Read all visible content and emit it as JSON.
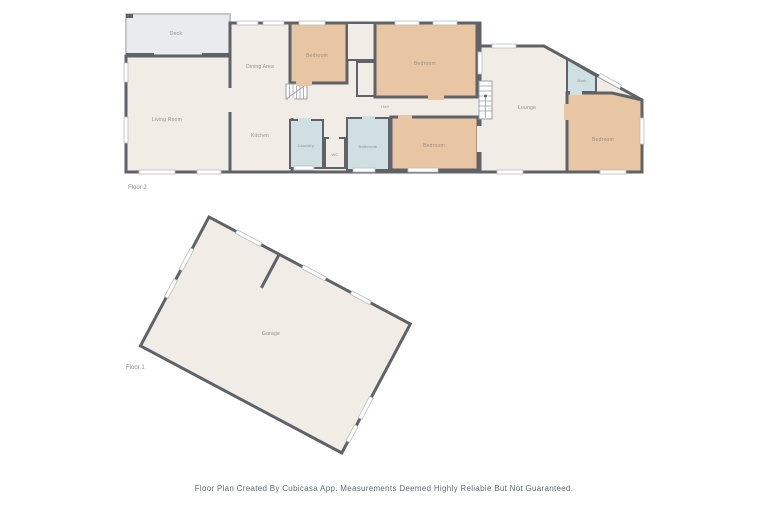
{
  "colors": {
    "wall": "#5f6368",
    "floor": "#f2ece6",
    "bedroom": "#e9c6a3",
    "wet": "#cfdfe2",
    "deck": "#e9ebed",
    "window": "#ffffff"
  },
  "floor2": {
    "label": "Floor 2",
    "rooms": {
      "deck": "Deck",
      "living": "Living Room",
      "dining": "Dining Area",
      "kitchen": "Kitchen",
      "bedroom1": "Bedroom",
      "bedroom2": "Bedroom",
      "hall": "Hall",
      "laundry": "Laundry",
      "wc": "WC",
      "bathroom": "Bathroom",
      "bedroom3": "Bedroom",
      "lounge": "Lounge",
      "bath": "Bath",
      "bedroom4": "Bedroom"
    }
  },
  "floor1": {
    "label": "Floor 1",
    "rooms": {
      "garage": "Garage"
    }
  },
  "footer": {
    "disclaimer": "Floor Plan Created By Cubicasa App. Measurements Deemed Highly Reliable But Not Guaranteed."
  }
}
